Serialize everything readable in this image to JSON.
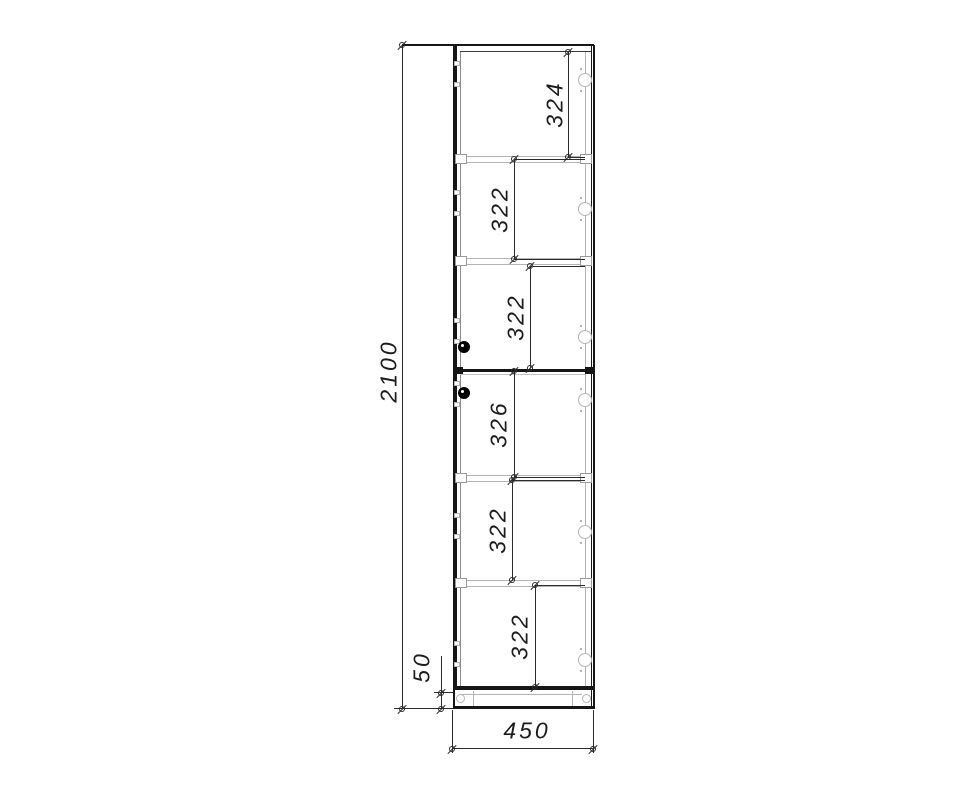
{
  "document": {
    "type": "furniture-cad-drawing",
    "description": "Front elevation of a tall single-column cabinet with two doors, shelves, hinges and plinth, with dimension lines"
  },
  "dimensions": {
    "overall_height": "2100",
    "width": "450",
    "plinth_height": "50",
    "sections_top_to_bottom": [
      "324",
      "322",
      "322",
      "326",
      "322",
      "322"
    ]
  },
  "colors": {
    "line_black": "#161616",
    "line_dark": "#2b2b2b",
    "line_mid": "#8a8a8a",
    "line_light": "#b4b4b4",
    "text": "#1c1c1c",
    "background": "#ffffff"
  },
  "drawing": {
    "cabinet": {
      "outer_left": 453,
      "outer_top": 45,
      "outer_right": 594,
      "body_bottom": 690,
      "plinth_bottom": 708,
      "inner_left": 460,
      "inner_right": 585,
      "inner_top": 51,
      "split_y": 369
    },
    "shelves_y": [
      156,
      258,
      475,
      580
    ],
    "hinges": {
      "cx": 585,
      "cy_list": [
        80,
        209,
        337,
        400,
        532,
        660
      ],
      "diameter": 14
    },
    "knobs": [
      {
        "cx": 464,
        "cy": 347
      },
      {
        "cx": 464,
        "cy": 393
      }
    ],
    "inner_dims": [
      {
        "label": "324",
        "x": 568,
        "y1": 52,
        "y2": 157,
        "lx": 555,
        "ly": 104,
        "leaders": [
          157
        ]
      },
      {
        "label": "322",
        "x": 514,
        "y1": 159,
        "y2": 259,
        "lx": 500,
        "ly": 209,
        "leaders": [
          159,
          259
        ]
      },
      {
        "label": "322",
        "x": 530,
        "y1": 266,
        "y2": 368,
        "lx": 516,
        "ly": 317,
        "leaders": [
          266
        ]
      },
      {
        "label": "326",
        "x": 514,
        "y1": 371,
        "y2": 477,
        "lx": 499,
        "ly": 424,
        "leaders": [
          477
        ]
      },
      {
        "label": "322",
        "x": 512,
        "y1": 480,
        "y2": 580,
        "lx": 498,
        "ly": 530,
        "leaders": [
          480
        ]
      },
      {
        "label": "322",
        "x": 535,
        "y1": 585,
        "y2": 687,
        "lx": 520,
        "ly": 636,
        "leaders": [
          585
        ]
      }
    ],
    "outer_dims": {
      "height": {
        "x": 402,
        "y1": 45,
        "y2": 709
      },
      "plinth": {
        "x": 441,
        "y1": 693,
        "y2": 709,
        "ext_top": 656
      },
      "width": {
        "y": 748,
        "x1": 452,
        "x2": 593,
        "ext_bottom": 753
      }
    }
  }
}
